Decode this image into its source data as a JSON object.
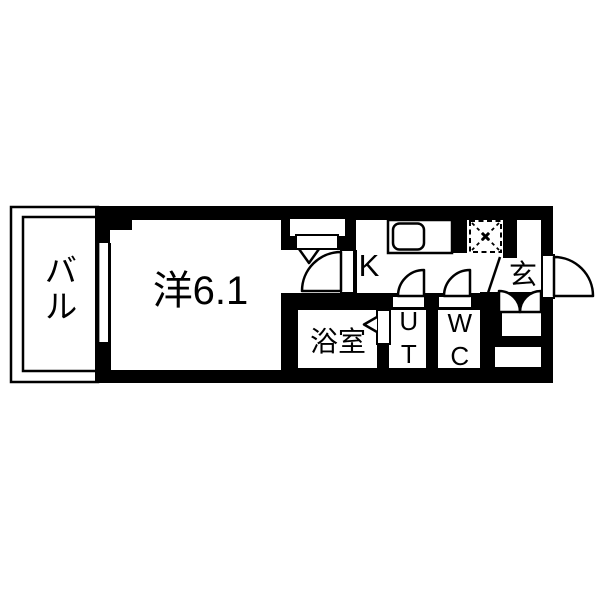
{
  "floorplan": {
    "rooms": {
      "balcony": {
        "label": "バル"
      },
      "main_room": {
        "label": "洋6.1",
        "size_tatami": "6.1"
      },
      "kitchen": {
        "label": "K"
      },
      "bathroom": {
        "label": "浴室"
      },
      "utility": {
        "label": "UT"
      },
      "toilet": {
        "label": "WC"
      },
      "entrance": {
        "label": "玄"
      }
    },
    "colors": {
      "wall": "#000000",
      "floor": "#ffffff",
      "background": "#ffffff",
      "text": "#000000"
    }
  }
}
